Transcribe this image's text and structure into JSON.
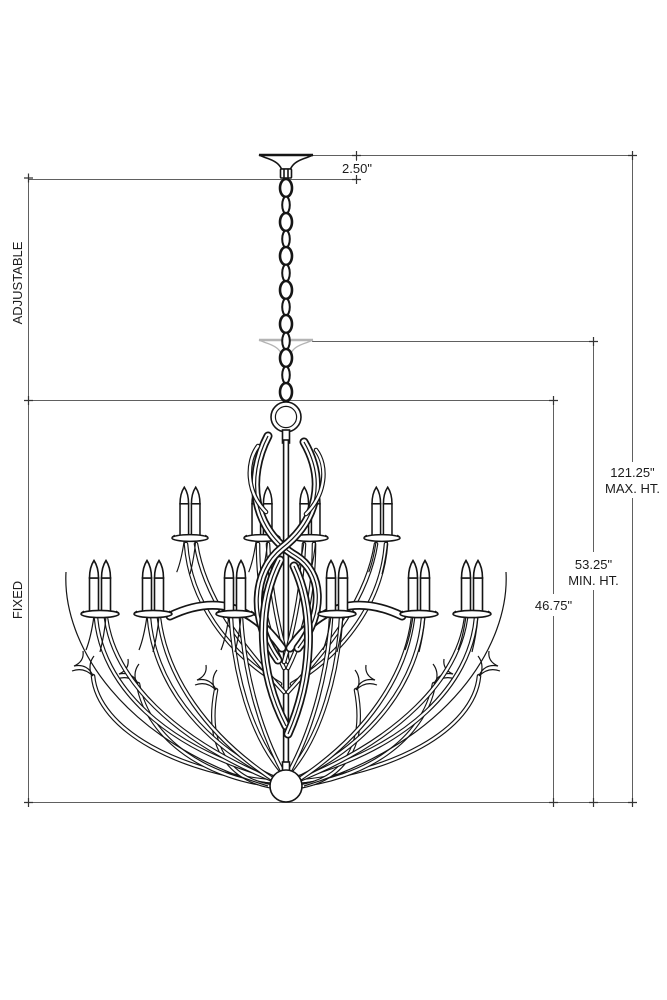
{
  "page": {
    "background": "#ffffff"
  },
  "drawing": {
    "type": "product-dimension-diagram",
    "subject": "two-tier 20-light candle chandelier, elevation line drawing with hanging dimensions",
    "labels": {
      "canopy_height": "2.50\"",
      "max_height_value": "121.25\"",
      "max_height_suffix": "MAX. HT.",
      "min_height_value": "53.25\"",
      "min_height_suffix": "MIN. HT.",
      "fixture_height": "46.75\"",
      "adjustable": "ADJUSTABLE",
      "fixed": "FIXED"
    },
    "colors": {
      "drawing_line": "#151515",
      "dimension_line": "#606060",
      "tick": "#333333",
      "ghost_line": "#b4b4b4",
      "label_text": "#1c1c1c",
      "background": "#ffffff"
    }
  }
}
